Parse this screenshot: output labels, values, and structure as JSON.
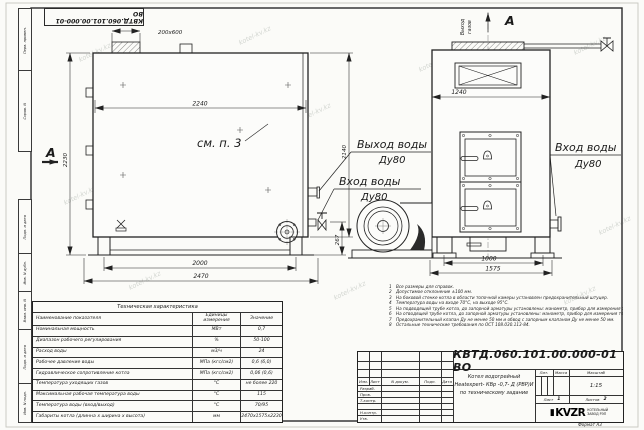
{
  "watermark": {
    "text": "kotel-kv.kz"
  },
  "sheet": {
    "stamp_doc_number": "КВТД.060.101.00.000-01 ВО",
    "format_label": "Формат  А3",
    "margin_labels": [
      "Перв. примен.",
      "Справ. N",
      "Подп. и дата",
      "Инв. N дубл.",
      "Взам. инв. N",
      "Подп. и дата",
      "Инв. N подл."
    ]
  },
  "drawing": {
    "section_mark": "А",
    "view_mark": "А",
    "opening_size": "200х600",
    "see_note": "см. п. 3",
    "outlet_label": "Выход воды",
    "outlet_dn": "Ду80",
    "inlet_label": "Вход воды",
    "inlet_dn": "Ду80",
    "inlet_right_label": "Вход воды",
    "inlet_right_dn": "Ду80",
    "gas_outlet_line1": "Выход",
    "gas_outlet_line2": "газов",
    "dims": {
      "d2240": "2240",
      "d2230": "2230",
      "d2140": "2140",
      "d267": "267",
      "d2000": "2000",
      "d2470": "2470",
      "d1240": "1240",
      "d1000": "1000",
      "d1575": "1575"
    }
  },
  "notes": {
    "items": [
      {
        "n": "1",
        "text": "Все размеры для справок."
      },
      {
        "n": "2",
        "text": "Допустимое отклонение ±100 мм."
      },
      {
        "n": "3",
        "text": "На боковой стенке котла в области топочной камеры установлен предохранительный штуцер."
      },
      {
        "n": "4",
        "text": "Температура воды на входе 70°С, на выходе 95°С."
      },
      {
        "n": "5",
        "text": "На подводящей трубе котла, до запорной арматуры установлены: манометр, прибор для измерения температуры."
      },
      {
        "n": "6",
        "text": "На отводящей трубе котла, до запорной арматуры установлены: манометр, прибор для измерения температуры."
      },
      {
        "n": "7",
        "text": "Предохранительный клапан Ду не менее 50 мм и обвод с запорным клапаном Ду не менее 50 мм."
      },
      {
        "n": "8",
        "text": "Остальные технические требования по ОСТ 108.030.113-84."
      }
    ]
  },
  "spec": {
    "title": "Техническая характеристика",
    "col_name": "Наименование показателя",
    "col_unit": "Единицы измерения",
    "col_value": "Значение",
    "rows": [
      {
        "name": "Номинальная мощность",
        "unit": "МВт",
        "value": "0,7"
      },
      {
        "name": "Диапазон рабочего регулирования",
        "unit": "%",
        "value": "50-100"
      },
      {
        "name": "Расход воды",
        "unit": "м3/ч",
        "value": "24"
      },
      {
        "name": "Рабочее давление воды",
        "unit": "МПа (кгс/см2)",
        "value": "0,6 (6,0)"
      },
      {
        "name": "Гидравлическое сопротивление котла",
        "unit": "МПа (кгс/см2)",
        "value": "0,06 (0,6)"
      },
      {
        "name": "Температура уходящих газов",
        "unit": "°С",
        "value": "не более 220"
      },
      {
        "name": "Максимальная рабочая температура воды",
        "unit": "°С",
        "value": "115"
      },
      {
        "name": "Температура воды (вход/выход)",
        "unit": "°С",
        "value": "70/95"
      },
      {
        "name": "Габариты котла (длинна х ширина х высота)",
        "unit": "мм",
        "value": "2470х1575х2230"
      }
    ]
  },
  "title_block": {
    "doc_number": "КВТД.060.101.00.000-01 ВО",
    "desc_line1": "Котел водогрейный",
    "desc_line2": "Heatexpert- КВр -0,7- Д (РВР)И",
    "desc_line3": "по техническому задание",
    "lit_label": "Лит.",
    "mass_label": "Масса",
    "scale_label": "Масштаб",
    "scale_value": "1:15",
    "sheet_label": "Лист",
    "sheet_value": "1",
    "sheets_label": "Листов",
    "sheets_value": "2",
    "logo_text": "KVZR",
    "company_line1": "КОТЕЛЬНЫЙ",
    "company_line2": "ЗАВОД РЭП",
    "rev_cols": {
      "izm": "Изм.",
      "list": "Лист",
      "doc": "N докум.",
      "podp": "Подп.",
      "data": "Дата"
    },
    "rev_rows": [
      "Разраб.",
      "Пров.",
      "Т.контр.",
      "",
      "Н.контр.",
      "Утв."
    ]
  }
}
